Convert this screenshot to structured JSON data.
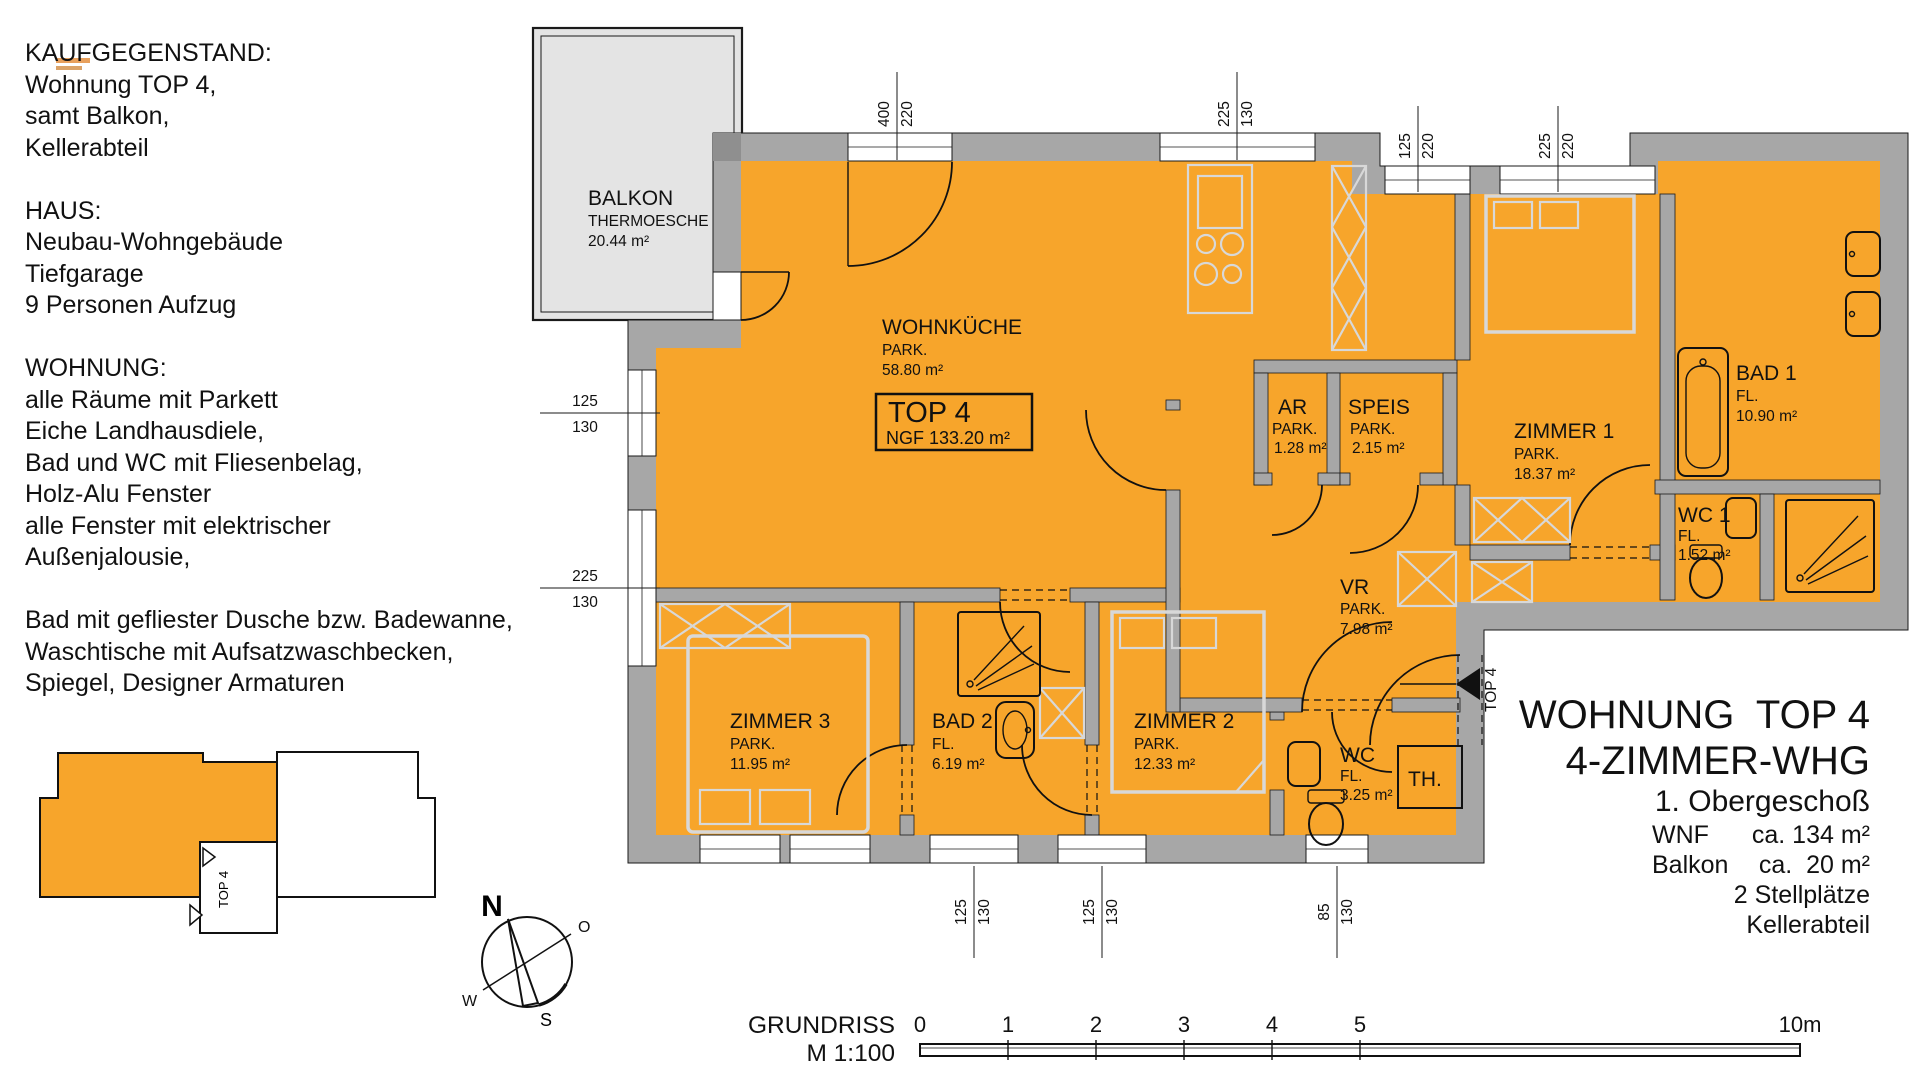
{
  "colors": {
    "accent": "#f7a52b",
    "wall": "#a7a7a7",
    "balcony_fill": "#e4e4e4",
    "furniture": "#d8d8d8",
    "outline": "#1a1a1a"
  },
  "left_panel": {
    "lines": [
      "KAUFGEGENSTAND:",
      "Wohnung TOP 4,",
      "samt Balkon,",
      "Kellerabteil",
      "",
      "HAUS:",
      "Neubau-Wohngebäude",
      "Tiefgarage",
      "9 Personen Aufzug",
      "",
      "WOHNUNG:",
      "alle Räume mit Parkett",
      "Eiche Landhausdiele,",
      "Bad und WC mit Fliesenbelag,",
      "Holz-Alu Fenster",
      "alle Fenster mit elektrischer",
      "Außenjalousie,",
      "",
      "Bad mit gefliester Dusche bzw. Badewanne,",
      "Waschtische mit Aufsatzwaschbecken,",
      "Spiegel, Designer Armaturen"
    ]
  },
  "plan": {
    "balcony": {
      "name": "BALKON",
      "material": "THERMOESCHE",
      "area": "20.44 m²"
    },
    "unit_box": {
      "title": "TOP 4",
      "ngf": "NGF 133.20 m²"
    },
    "rooms": {
      "wohnkueche": {
        "name": "WOHNKÜCHE",
        "floor": "PARK.",
        "area": "58.80 m²"
      },
      "ar": {
        "name": "AR",
        "floor": "PARK.",
        "area": "1.28 m²"
      },
      "speis": {
        "name": "SPEIS",
        "floor": "PARK.",
        "area": "2.15 m²"
      },
      "zimmer1": {
        "name": "ZIMMER 1",
        "floor": "PARK.",
        "area": "18.37 m²"
      },
      "bad1": {
        "name": "BAD 1",
        "floor": "FL.",
        "area": "10.90 m²"
      },
      "wc1": {
        "name": "WC 1",
        "floor": "FL.",
        "area": "1.52 m²"
      },
      "vr": {
        "name": "VR",
        "floor": "PARK.",
        "area": "7.98 m²"
      },
      "zimmer3": {
        "name": "ZIMMER 3",
        "floor": "PARK.",
        "area": "11.95 m²"
      },
      "bad2": {
        "name": "BAD 2",
        "floor": "FL.",
        "area": "6.19 m²"
      },
      "zimmer2": {
        "name": "ZIMMER 2",
        "floor": "PARK.",
        "area": "12.33 m²"
      },
      "wc": {
        "name": "WC",
        "floor": "FL.",
        "area": "3.25 m²"
      },
      "th": {
        "label": "TH."
      }
    },
    "entrance_label": "TOP 4",
    "dimensions": {
      "top": [
        {
          "a": "400",
          "b": "220"
        },
        {
          "a": "225",
          "b": "130"
        },
        {
          "a": "125",
          "b": "220"
        },
        {
          "a": "225",
          "b": "220"
        }
      ],
      "left": [
        {
          "a": "125",
          "b": "130"
        },
        {
          "a": "225",
          "b": "130"
        }
      ],
      "bottom": [
        {
          "a": "125",
          "b": "130"
        },
        {
          "a": "125",
          "b": "130"
        },
        {
          "a": "85",
          "b": "130"
        }
      ]
    },
    "compass": {
      "n": "N",
      "e": "O",
      "s": "S",
      "w": "W"
    },
    "keyplan": {
      "unit_label": "TOP 4"
    }
  },
  "info_panel": {
    "line1": "WOHNUNG  TOP 4",
    "line2": "4-ZIMMER-WHG",
    "line3": "1. Obergeschoß",
    "rows": [
      {
        "label": "WNF",
        "value": "ca. 134 m²"
      },
      {
        "label": "Balkon",
        "value": "ca.  20 m²"
      }
    ],
    "line6": "2 Stellplätze",
    "line7": "Kellerabteil"
  },
  "footer": {
    "title": "GRUNDRISS",
    "scale": "M 1:100",
    "ticks": [
      "0",
      "1",
      "2",
      "3",
      "4",
      "5"
    ],
    "end_label": "10m"
  }
}
